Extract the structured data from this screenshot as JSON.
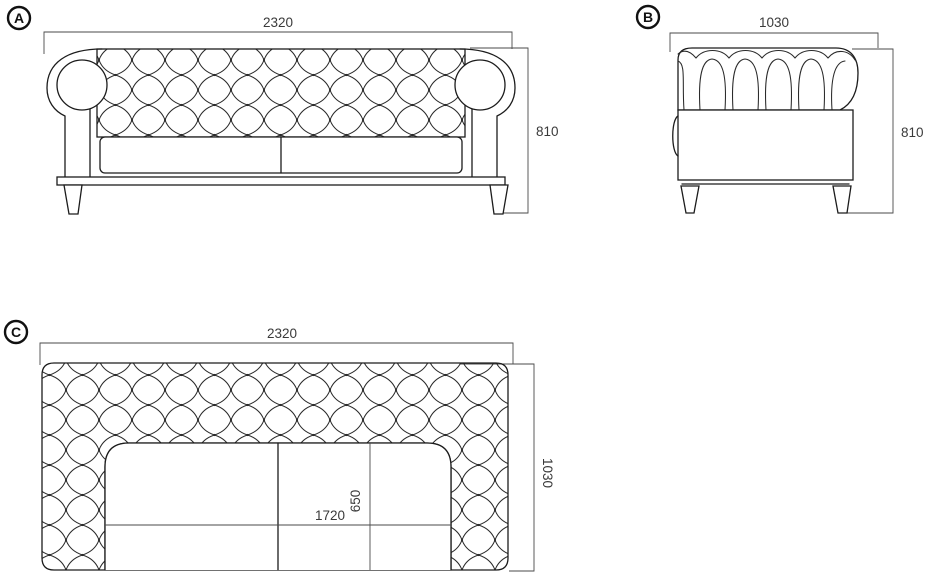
{
  "drawing": {
    "type": "furniture-orthographic-dimension-drawing",
    "subject": "chesterfield-sofa",
    "views": [
      {
        "label": "A",
        "name": "front-view",
        "width_dim": "2320",
        "height_dim": "810"
      },
      {
        "label": "B",
        "name": "side-view",
        "width_dim": "1030",
        "height_dim": "810"
      },
      {
        "label": "C",
        "name": "top-view",
        "width_dim": "2320",
        "depth_dim": "1030",
        "seat_width_dim": "1720",
        "seat_depth_dim": "650"
      }
    ],
    "colors": {
      "object_line": "#1c1c1c",
      "tufting_line": "#2a2a2a",
      "dimension_line": "#4a4a4a",
      "dimension_text": "#3a3a3a",
      "background": "#ffffff"
    }
  }
}
